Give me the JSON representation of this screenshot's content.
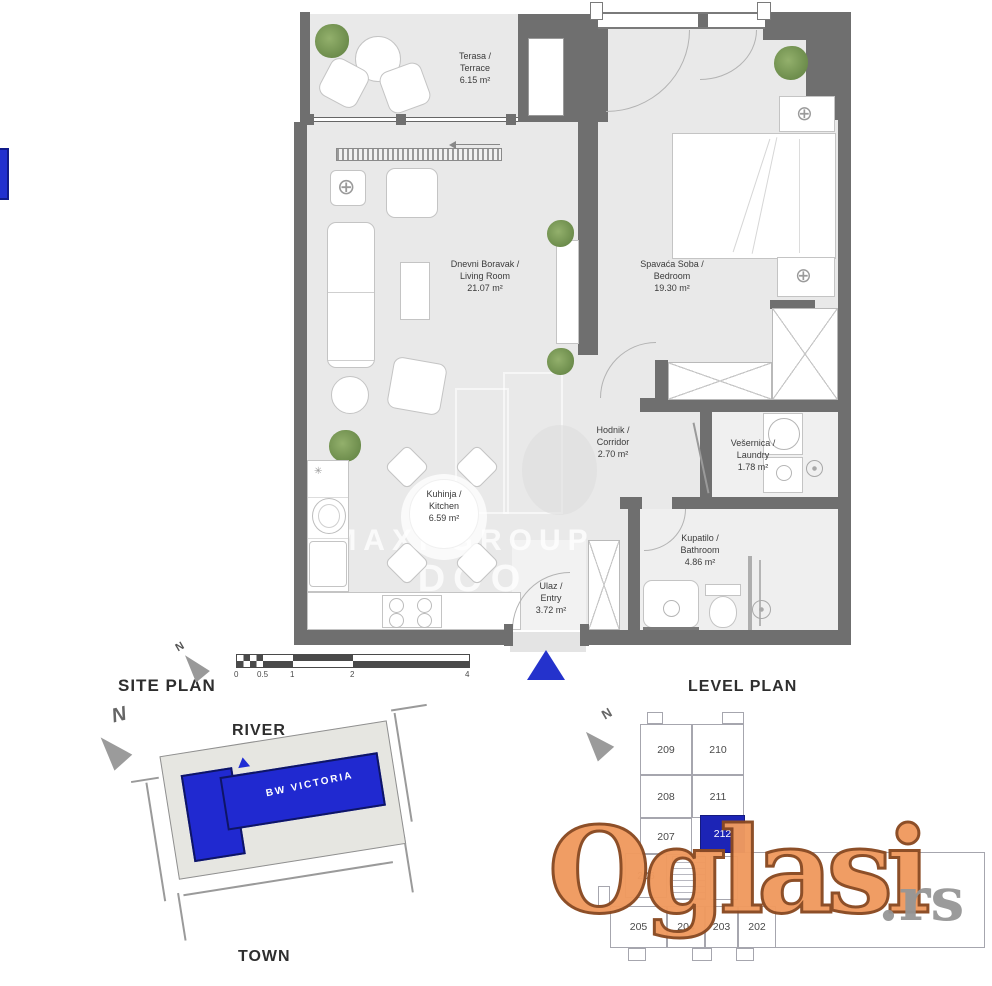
{
  "floor_plan": {
    "rooms": {
      "terrace": {
        "name": "Terasa /",
        "name_en": "Terrace",
        "area": "6.15 m²"
      },
      "living": {
        "name": "Dnevni Boravak /",
        "name_en": "Living Room",
        "area": "21.07 m²"
      },
      "bedroom": {
        "name": "Spavaća Soba /",
        "name_en": "Bedroom",
        "area": "19.30 m²"
      },
      "corridor": {
        "name": "Hodnik /",
        "name_en": "Corridor",
        "area": "2.70 m²"
      },
      "laundry": {
        "name": "Vešernica /",
        "name_en": "Laundry",
        "area": "1.78 m²"
      },
      "kitchen": {
        "name": "Kuhinja /",
        "name_en": "Kitchen",
        "area": "6.59 m²"
      },
      "entry": {
        "name": "Ulaz /",
        "name_en": "Entry",
        "area": "3.72 m²"
      },
      "bathroom": {
        "name": "Kupatilo /",
        "name_en": "Bathroom",
        "area": "4.86 m²"
      }
    },
    "center_watermark": {
      "line1": "MAXI GROUP",
      "line2": "DOO"
    }
  },
  "scale_bar": {
    "ticks": [
      "0",
      "0.5",
      "1",
      "2",
      "4"
    ]
  },
  "site_plan": {
    "title": "SITE PLAN",
    "north_label": "N",
    "river_label": "RIVER",
    "town_label": "TOWN",
    "building_name": "BW VICTORIA"
  },
  "level_plan": {
    "title": "LEVEL PLAN",
    "north_label": "N",
    "units": [
      "209",
      "210",
      "208",
      "211",
      "207",
      "212",
      "206",
      "205",
      "204",
      "203",
      "202"
    ],
    "highlighted_unit": "212"
  },
  "watermark": {
    "brand": "Oglasi",
    "tld": ".rs"
  },
  "colors": {
    "accent_blue": "#2029d0",
    "highlight_blue": "#1c24b6",
    "watermark_orange": "#f09a5f",
    "wall_gray": "#6f6f6f"
  }
}
